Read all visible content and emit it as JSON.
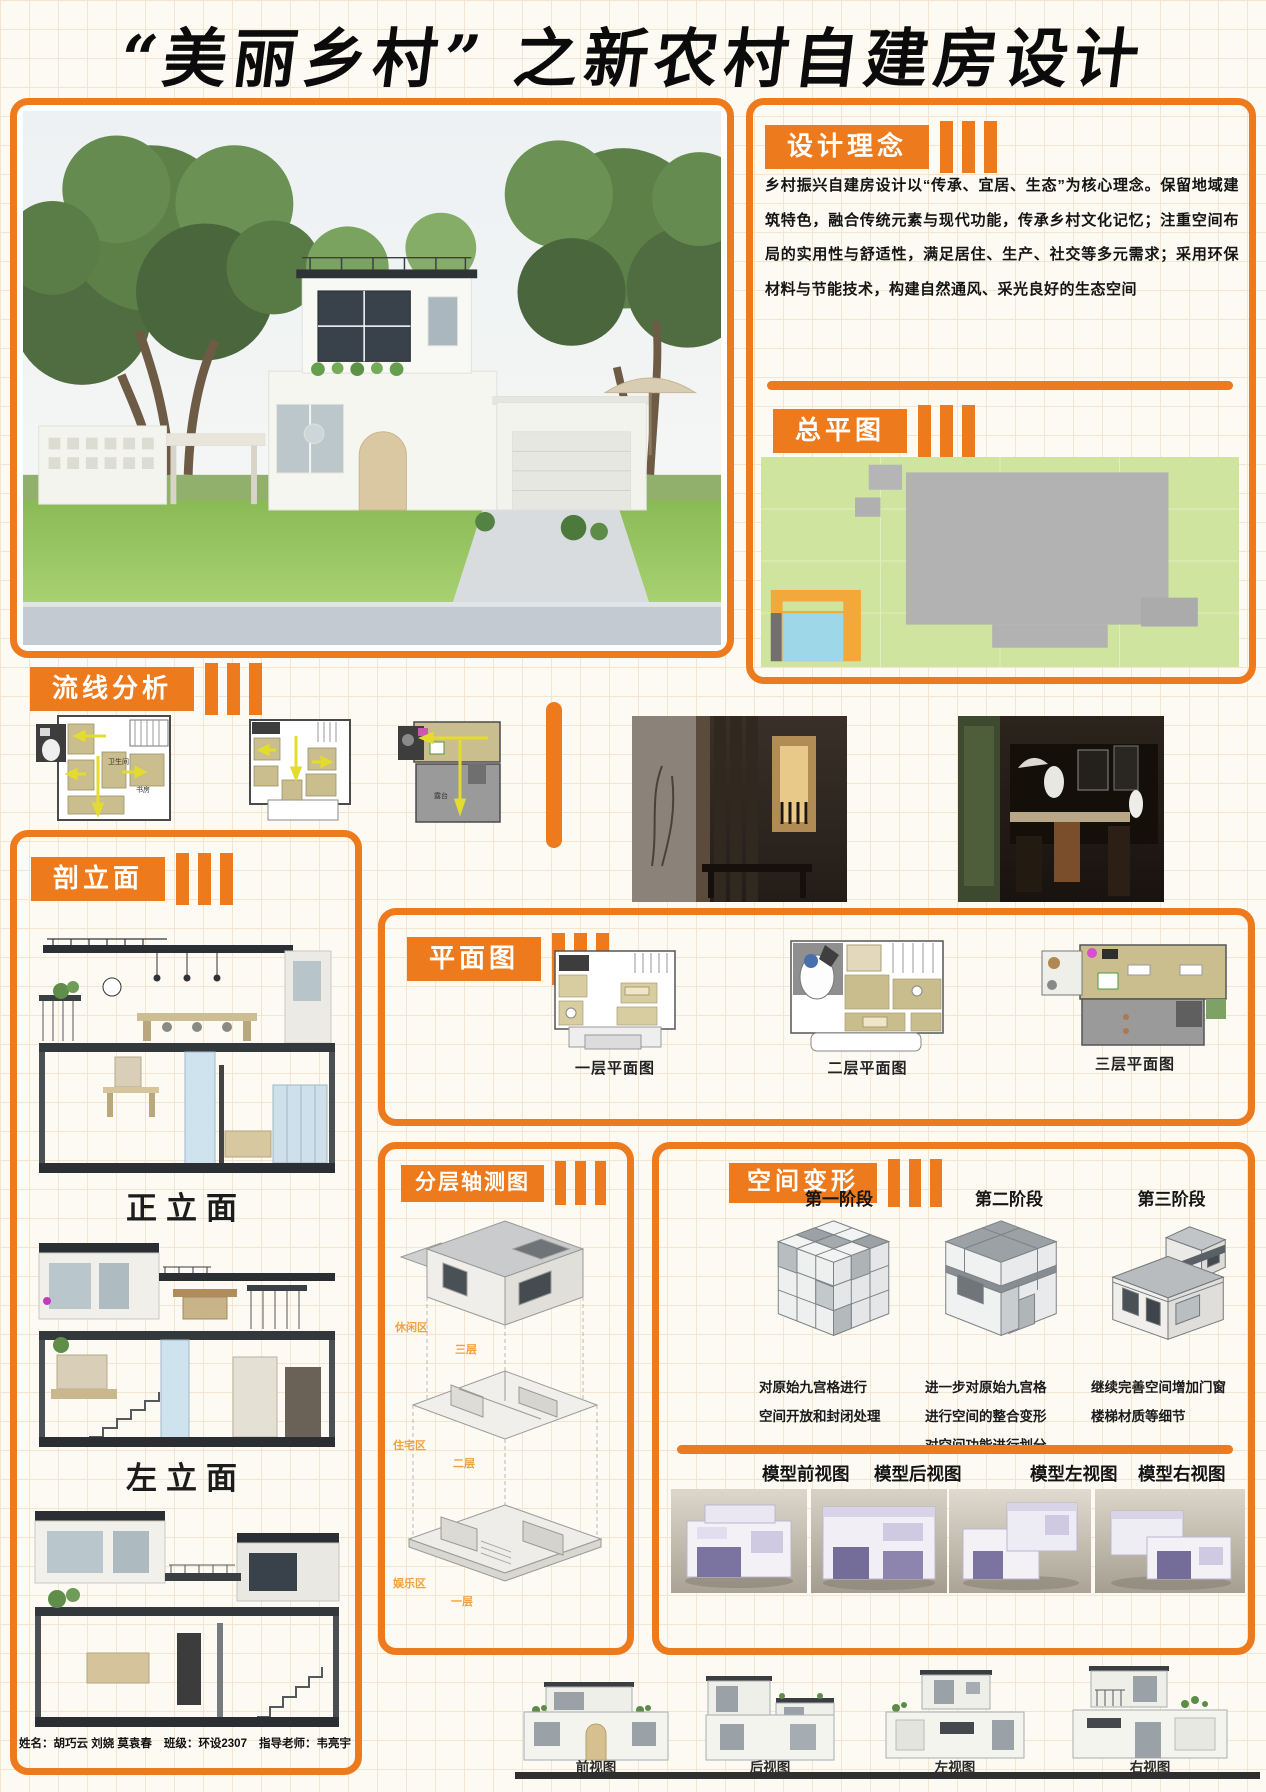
{
  "title": "“美丽乡村” 之新农村自建房设计",
  "colors": {
    "accent": "#ED7A1D",
    "grid_bg": "#FCFAF3"
  },
  "concept": {
    "header": "设计理念",
    "body": "乡村振兴自建房设计以“传承、宜居、生态”为核心理念。保留地域建筑特色，融合传统元素与现代功能，传承乡村文化记忆；注重空间布局的实用性与舒适性，满足居住、生产、社交等多元需求；采用环保材料与节能技术，构建自然通风、采光良好的生态空间"
  },
  "site_plan": {
    "header": "总平图"
  },
  "circulation": {
    "header": "流线分析",
    "tiny_labels": {
      "bath": "卫生间",
      "study": "书房",
      "terrace": "露台"
    }
  },
  "sections": {
    "header": "剖立面",
    "label_front": "正立面",
    "label_left": "左立面"
  },
  "floor_plans": {
    "header": "平面图",
    "labels": [
      "一层平面图",
      "二层平面图",
      "三层平面图"
    ]
  },
  "axonometric": {
    "header": "分层轴测图",
    "levels": [
      {
        "zone": "休闲区",
        "floor": "三层"
      },
      {
        "zone": "住宅区",
        "floor": "二层"
      },
      {
        "zone": "娱乐区",
        "floor": "一层"
      }
    ]
  },
  "transformation": {
    "header": "空间变形",
    "stages": [
      {
        "label": "第一阶段",
        "desc_lines": [
          "对原始九宫格进行",
          "空间开放和封闭处理"
        ]
      },
      {
        "label": "第二阶段",
        "desc_lines": [
          "进一步对原始九宫格",
          "进行空间的整合变形",
          "对空间功能进行划分"
        ]
      },
      {
        "label": "第三阶段",
        "desc_lines": [
          "继续完善空间增加门窗",
          "楼梯材质等细节"
        ]
      }
    ],
    "model_views": [
      "模型前视图",
      "模型后视图",
      "模型左视图",
      "模型右视图"
    ]
  },
  "bottom_elevations": {
    "labels": [
      "前视图",
      "后视图",
      "左视图",
      "右视图"
    ]
  },
  "footer": {
    "name": "姓名：胡巧云 刘娆 莫袁春",
    "class": "班级：环设2307",
    "teacher": "指导老师：韦亮宇"
  }
}
